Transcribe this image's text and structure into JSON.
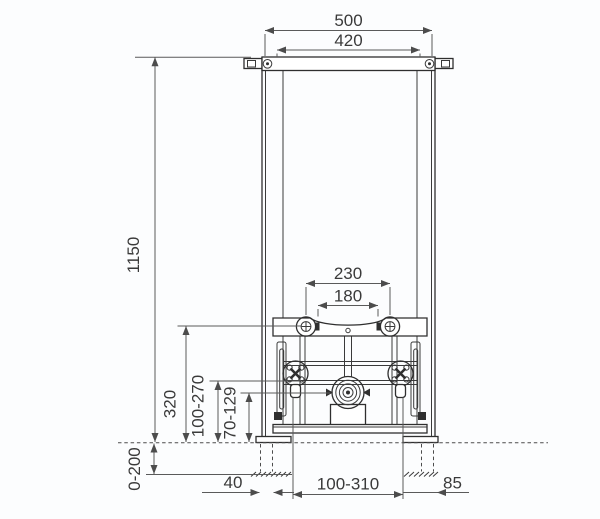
{
  "drawing": {
    "type": "technical-dimension-drawing",
    "subject": "wall-mounted bidet installation frame, front view",
    "units": "mm",
    "background_color": "#fcfdfe",
    "line_color": "#2f2f2f",
    "dimension_line_color": "#5a5a5a",
    "text_color": "#3a3a3a",
    "dimensions": {
      "outer_width_top": "500",
      "inner_width_top": "420",
      "frame_height": "1150",
      "bolt_spacing_outer": "230",
      "bolt_spacing_inner": "180",
      "crossbar_height_above_floor": "320",
      "water_connection_height_range": "100-270",
      "drain_height_range": "70-129",
      "foot_adjustment_range": "0-200",
      "foot_leg_width": "40",
      "connection_lateral_range": "100-310",
      "side_offset": "85"
    }
  }
}
